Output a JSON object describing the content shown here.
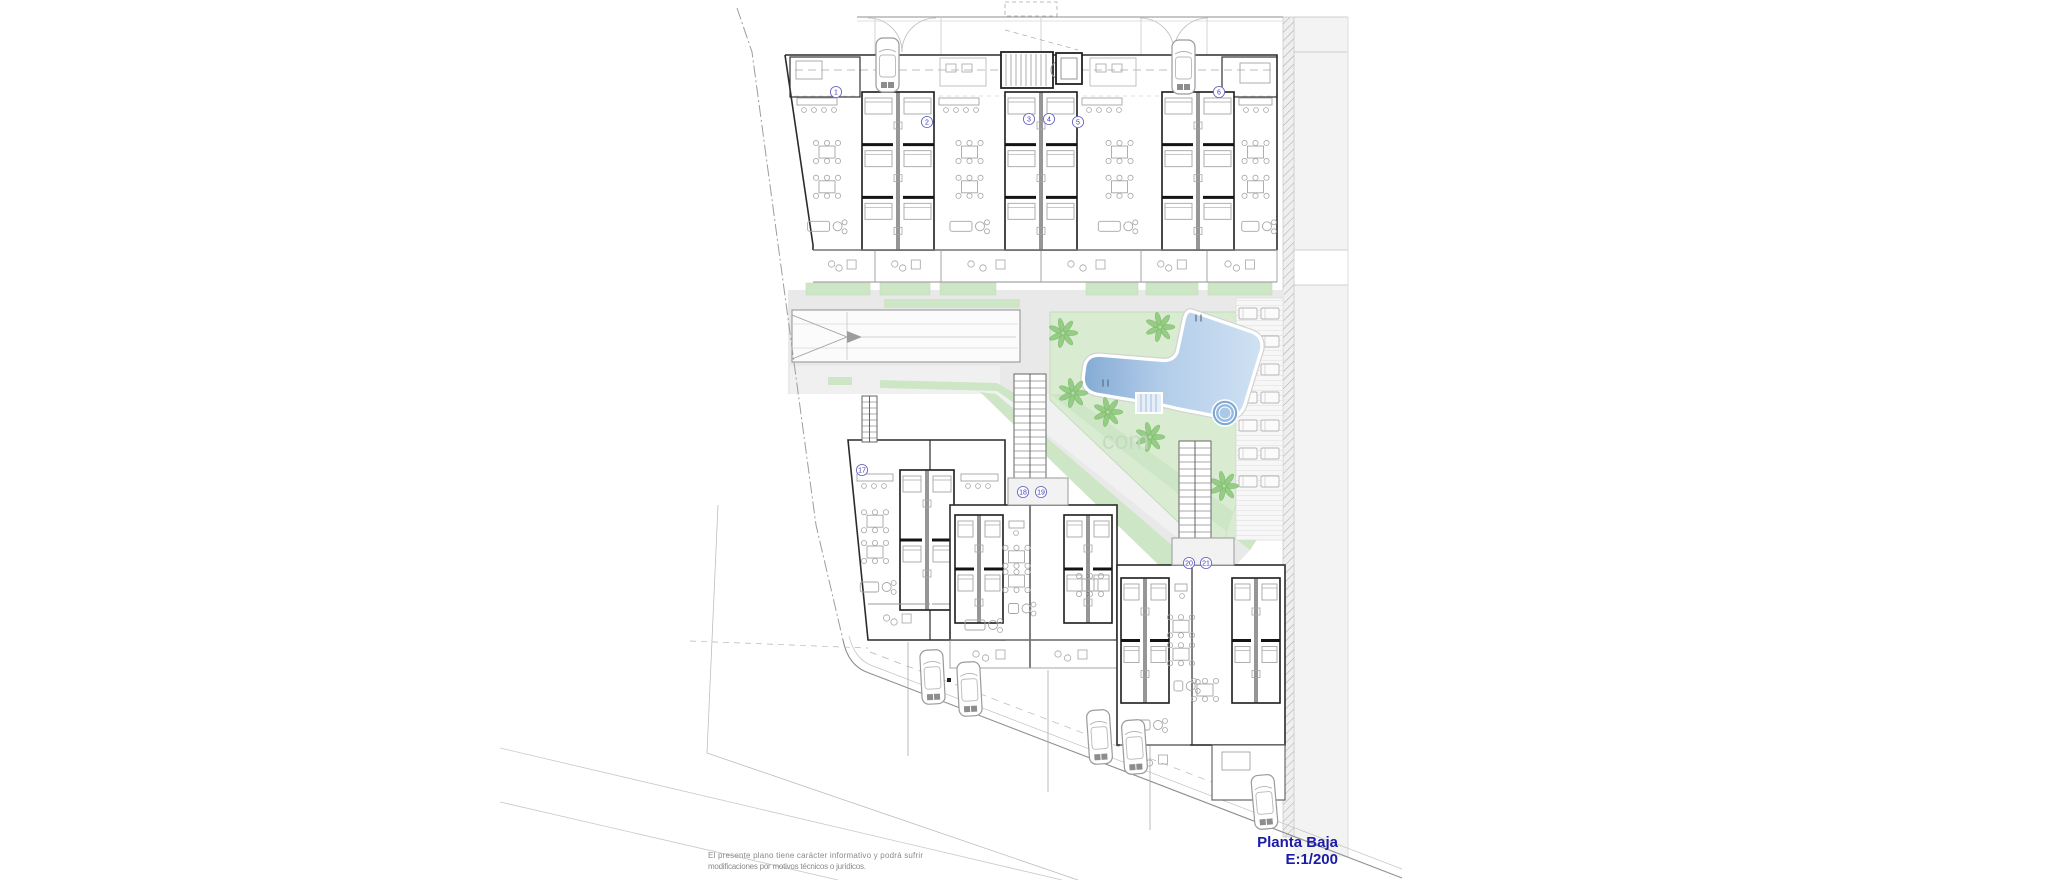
{
  "document": {
    "type": "architectural-floor-plan",
    "title": "Planta Baja",
    "scale": "E:1/200",
    "disclaimer_line1": "El presente plano tiene carácter informativo y podrá sufrir",
    "disclaimer_line2": "modificaciones por motivos técnicos o jurídicos.",
    "watermark_fragment": "com"
  },
  "colors": {
    "wall_dark": "#1c1c1c",
    "wall_light": "#9a9a9a",
    "furniture": "#a6a6a6",
    "ground_gray": "#e9e9e9",
    "neighbor_gray": "#f3f3f3",
    "deck_gray": "#f6f6f6",
    "lawn_green": "#d9ecd2",
    "strip_green": "#cde7c6",
    "palm_green": "#8fc97e",
    "pool_dark": "#88aed6",
    "pool_light": "#cfe1f3",
    "spa_blue": "#7fa9d4",
    "label_blue": "#3c3cb4",
    "title_blue": "#1b1ba8",
    "disclaimer_gray": "#8a8a8a",
    "boundary_gray": "#9d9d9d",
    "watermark_green": "#c2d6c2"
  },
  "top_row_unit_labels": [
    {
      "number": "1",
      "x": 836,
      "y": 92
    },
    {
      "number": "2",
      "x": 927,
      "y": 122
    },
    {
      "number": "3",
      "x": 1029,
      "y": 119
    },
    {
      "number": "4",
      "x": 1049,
      "y": 119
    },
    {
      "number": "5",
      "x": 1078,
      "y": 122
    },
    {
      "number": "6",
      "x": 1219,
      "y": 92
    }
  ],
  "bottom_row_unit_labels": [
    {
      "number": "17",
      "x": 862,
      "y": 470
    },
    {
      "number": "18",
      "x": 1023,
      "y": 492
    },
    {
      "number": "19",
      "x": 1041,
      "y": 492
    },
    {
      "number": "20",
      "x": 1189,
      "y": 563
    },
    {
      "number": "21",
      "x": 1206,
      "y": 563
    }
  ],
  "garage_cars": [
    {
      "x": 876,
      "y": 38
    },
    {
      "x": 1172,
      "y": 40
    }
  ],
  "street_cars": [
    {
      "x": 921,
      "y": 650,
      "r": -3
    },
    {
      "x": 958,
      "y": 662,
      "r": -3
    },
    {
      "x": 1088,
      "y": 710,
      "r": -4
    },
    {
      "x": 1123,
      "y": 720,
      "r": -4
    },
    {
      "x": 1253,
      "y": 775,
      "r": -5
    }
  ],
  "palm_trees": [
    {
      "x": 1063,
      "y": 333
    },
    {
      "x": 1160,
      "y": 327
    },
    {
      "x": 1073,
      "y": 393
    },
    {
      "x": 1108,
      "y": 412
    },
    {
      "x": 1150,
      "y": 437
    },
    {
      "x": 1193,
      "y": 462
    },
    {
      "x": 1224,
      "y": 486
    }
  ],
  "sunbed_rows": [
    308,
    336,
    364,
    392,
    420,
    448,
    476
  ]
}
